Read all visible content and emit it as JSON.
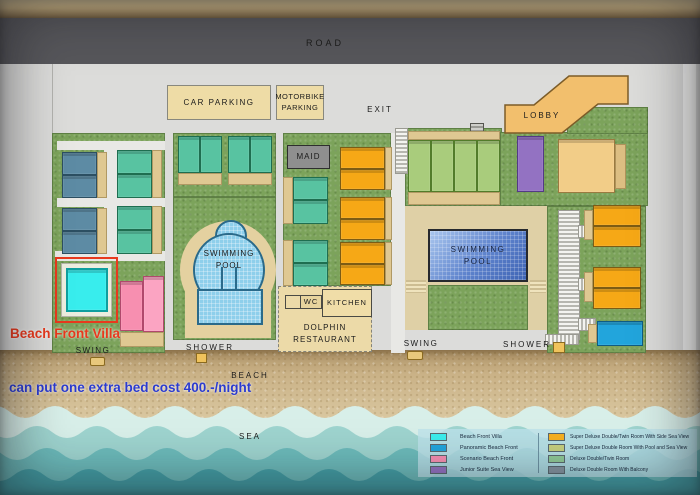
{
  "map": {
    "road": "ROAD",
    "car_parking": "CAR PARKING",
    "motorbike_parking": "MOTORBIKE\nPARKING",
    "exit": "EXIT",
    "lobby": "LOBBY",
    "maid": "MAID",
    "swimming_pool": "SWIMMING\nPOOL",
    "wc": "WC",
    "kitchen": "KITCHEN",
    "dolphin_restaurant": "DOLPHIN\nRESTAURANT",
    "shower": "SHOWER",
    "swing": "SWING",
    "beach": "BEACH",
    "sea": "SEA"
  },
  "annotations": {
    "villa_label": "Beach Front Villa",
    "extra_bed_note": "can put one extra bed cost 400.-/night"
  },
  "legend": {
    "left": [
      {
        "label": "Beach Front Villa",
        "color": "#3ceded"
      },
      {
        "label": "Panoramic Beach Front",
        "color": "#22a5dc"
      },
      {
        "label": "Scenario Beach Front",
        "color": "#f78fb2"
      },
      {
        "label": "Junior Suite Sea View",
        "color": "#9372c2"
      }
    ],
    "right": [
      {
        "label": "Super Deluxe Double/Twin Room With Side Sea View",
        "color": "#f6b021"
      },
      {
        "label": "Super Deluxe Double Room With Pool and Sea View",
        "color": "#c6cf7e"
      },
      {
        "label": "Deluxe Double/Twin Room",
        "color": "#8fca96"
      },
      {
        "label": "Deluxe Double Room With Balcony",
        "color": "#8494a0"
      }
    ]
  },
  "colors": {
    "annotation_red": "#e8391d",
    "annotation_blue": "#2b3bcf",
    "road_gray": "#57575b",
    "grass_green": "#7ca35b",
    "sand": "#d3bd92",
    "sea_teal": "#45a1a7"
  }
}
